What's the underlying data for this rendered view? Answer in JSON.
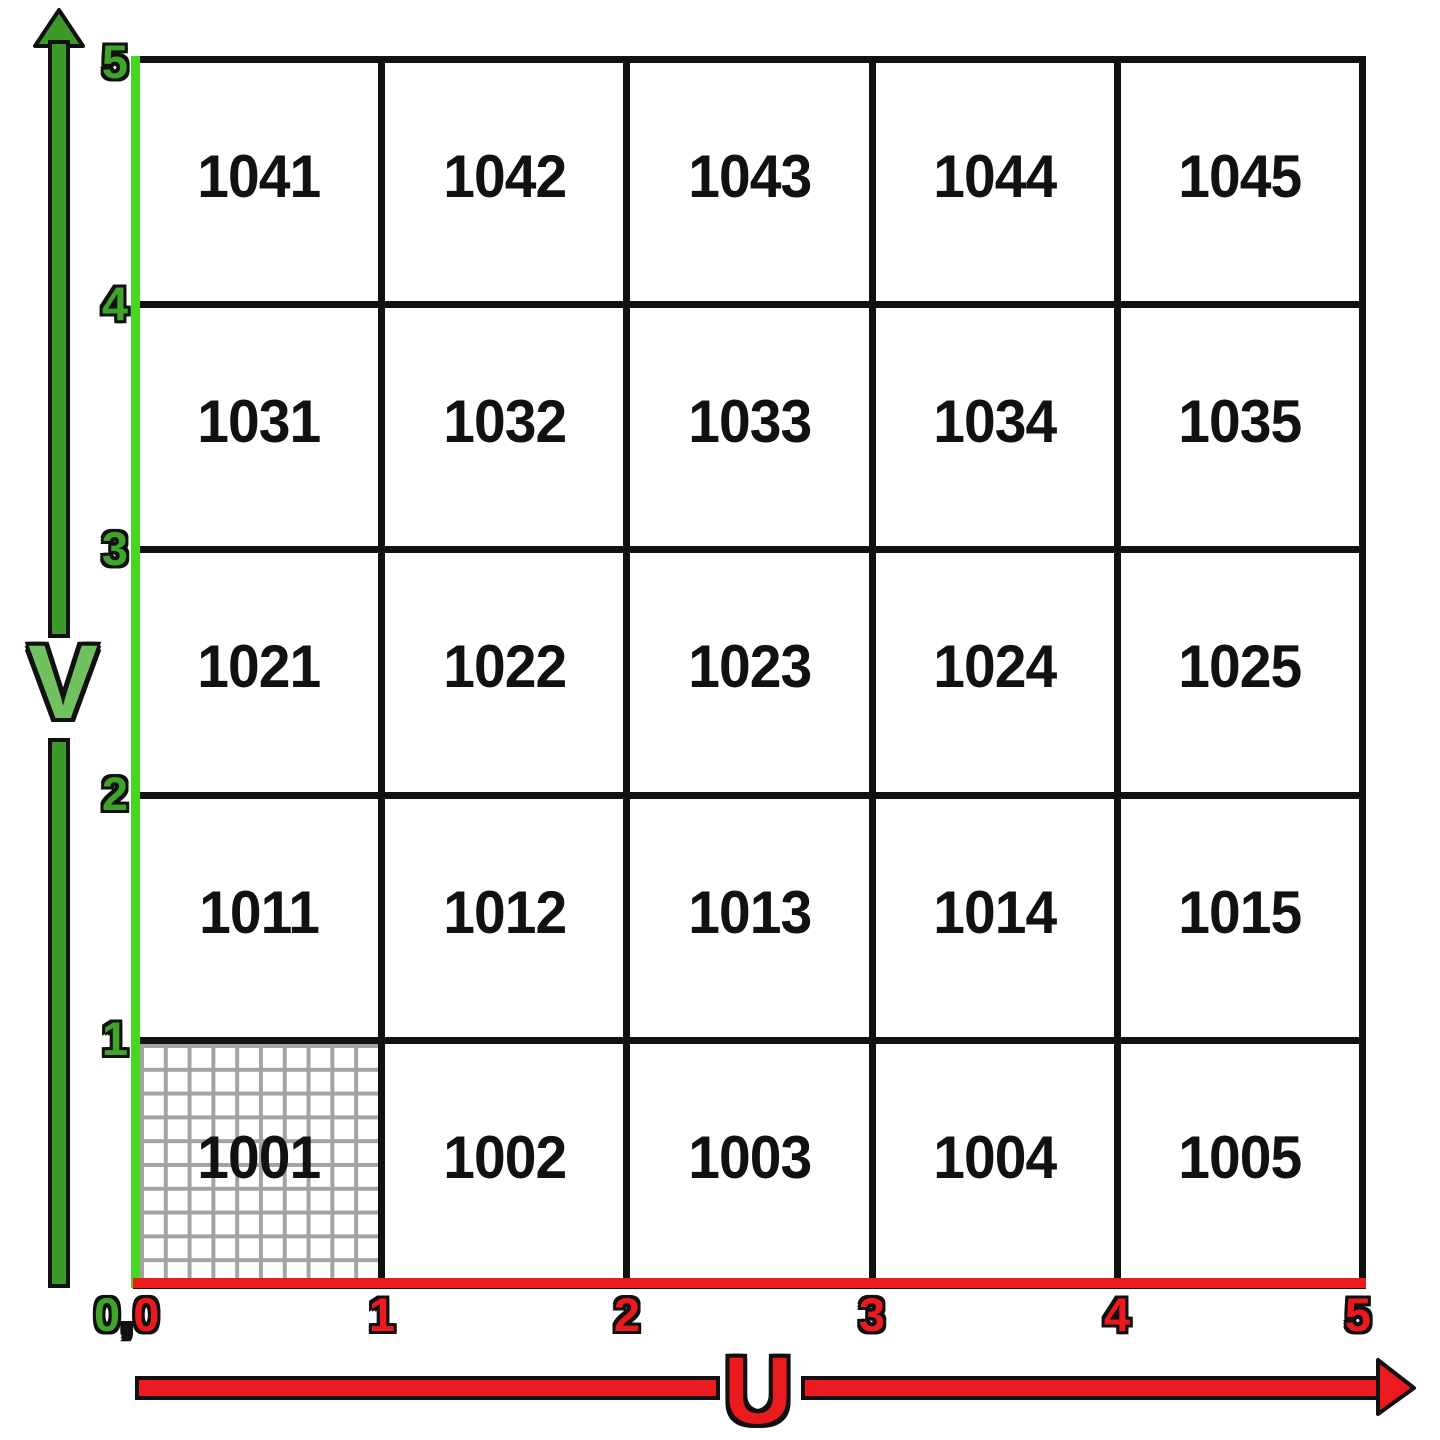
{
  "grid": {
    "rows": [
      {
        "cells": [
          "1041",
          "1042",
          "1043",
          "1044",
          "1045"
        ]
      },
      {
        "cells": [
          "1031",
          "1032",
          "1033",
          "1034",
          "1035"
        ]
      },
      {
        "cells": [
          "1021",
          "1022",
          "1023",
          "1024",
          "1025"
        ]
      },
      {
        "cells": [
          "1011",
          "1012",
          "1013",
          "1014",
          "1015"
        ]
      },
      {
        "cells": [
          "1001",
          "1002",
          "1003",
          "1004",
          "1005"
        ]
      }
    ],
    "textured_tile": "1001"
  },
  "axes": {
    "u": {
      "label": "U",
      "ticks": [
        "1",
        "2",
        "3",
        "4",
        "5"
      ]
    },
    "v": {
      "label": "V",
      "ticks": [
        "5",
        "4",
        "3",
        "2",
        "1"
      ]
    },
    "origin": {
      "v_zero": "0",
      "separator": ",",
      "u_zero": "0"
    }
  },
  "colors": {
    "u_axis_red": "#ea1a1e",
    "v_axis_lime": "#47d621",
    "v_arrow_green": "#3e9a28",
    "v_letter_green": "#72c160",
    "v_tick_green": "#3fa42c",
    "grid_line_black": "#111111",
    "fine_grid_gray": "#a3a3a3",
    "tile_background": "#ffffff"
  }
}
